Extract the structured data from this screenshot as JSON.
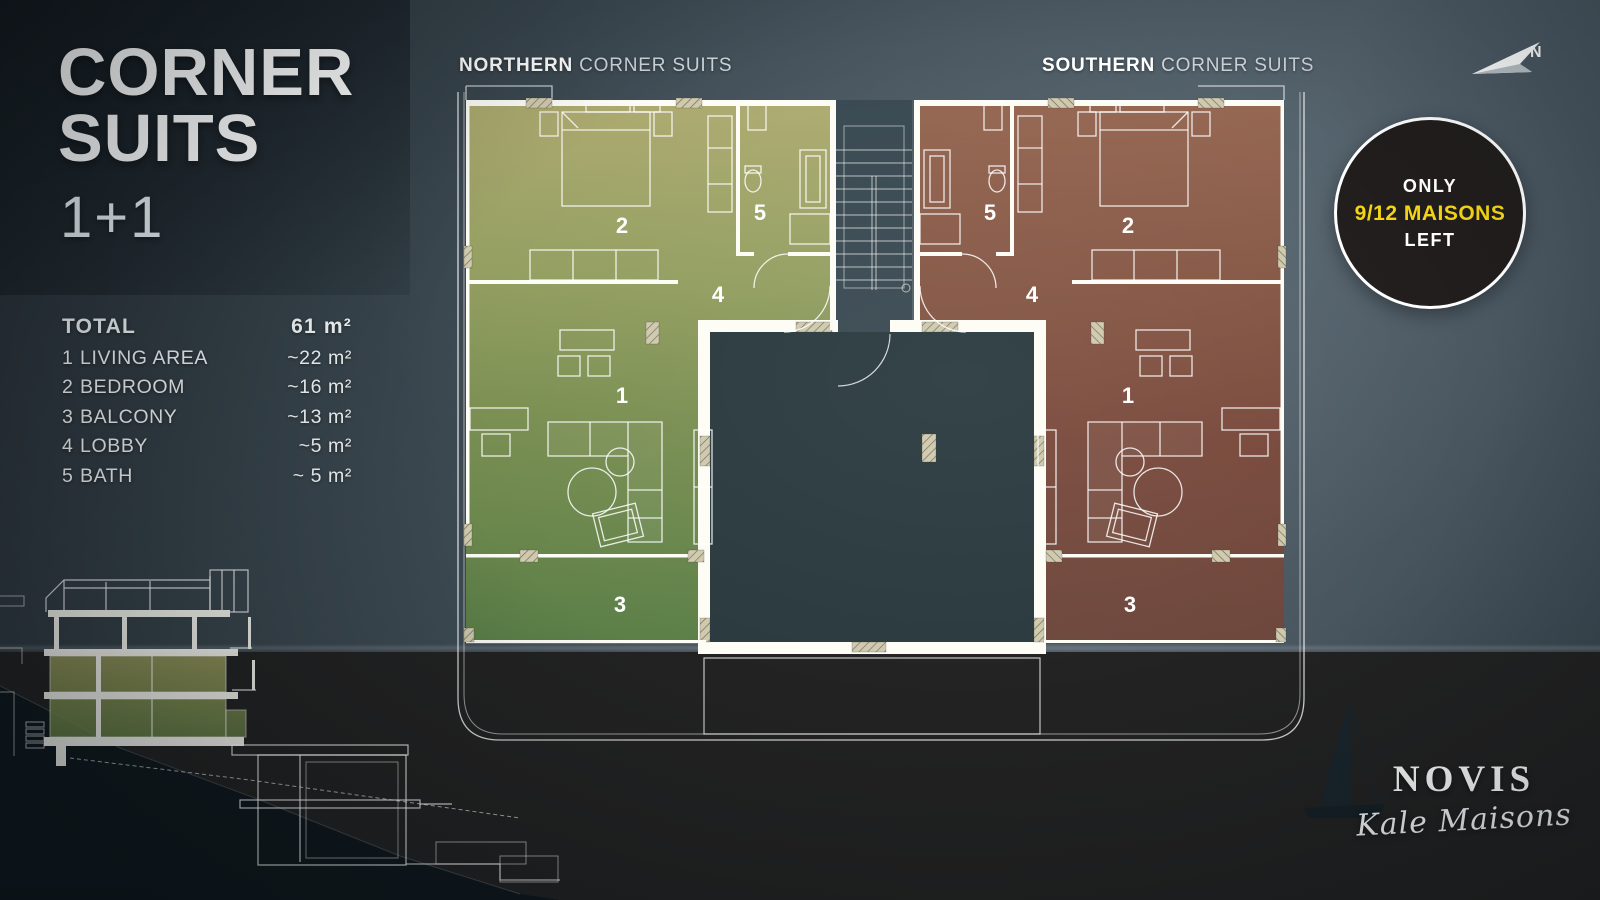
{
  "title": {
    "line1": "CORNER",
    "line2": "SUITS",
    "subtitle": "1+1"
  },
  "legend": {
    "total_label": "TOTAL",
    "total_value": "61 m²",
    "rows": [
      {
        "num": "1",
        "label": "LIVING AREA",
        "value": "~22 m²"
      },
      {
        "num": "2",
        "label": "BEDROOM",
        "value": "~16 m²"
      },
      {
        "num": "3",
        "label": "BALCONY",
        "value": "~13 m²"
      },
      {
        "num": "4",
        "label": "LOBBY",
        "value": "~5 m²"
      },
      {
        "num": "5",
        "label": "BATH",
        "value": "~ 5 m²"
      }
    ]
  },
  "plan": {
    "north": {
      "bold": "NORTHERN",
      "rest": " CORNER SUITS"
    },
    "south": {
      "bold": "SOUTHERN",
      "rest": " CORNER SUITS"
    },
    "room_numbers": {
      "living": "1",
      "bedroom": "2",
      "balcony": "3",
      "lobby": "4",
      "bath": "5"
    }
  },
  "badge": {
    "line1": "ONLY",
    "line2": "9/12 MAISONS",
    "line3": "LEFT",
    "accent_color": "#f3d515"
  },
  "compass": {
    "label": "N"
  },
  "brand": {
    "name": "NOVIS",
    "script": "Kale Maisons"
  },
  "colors": {
    "north_suite_green": "#7d9351",
    "south_suite_red": "#7c4839",
    "badge_yellow": "#f3d515"
  }
}
